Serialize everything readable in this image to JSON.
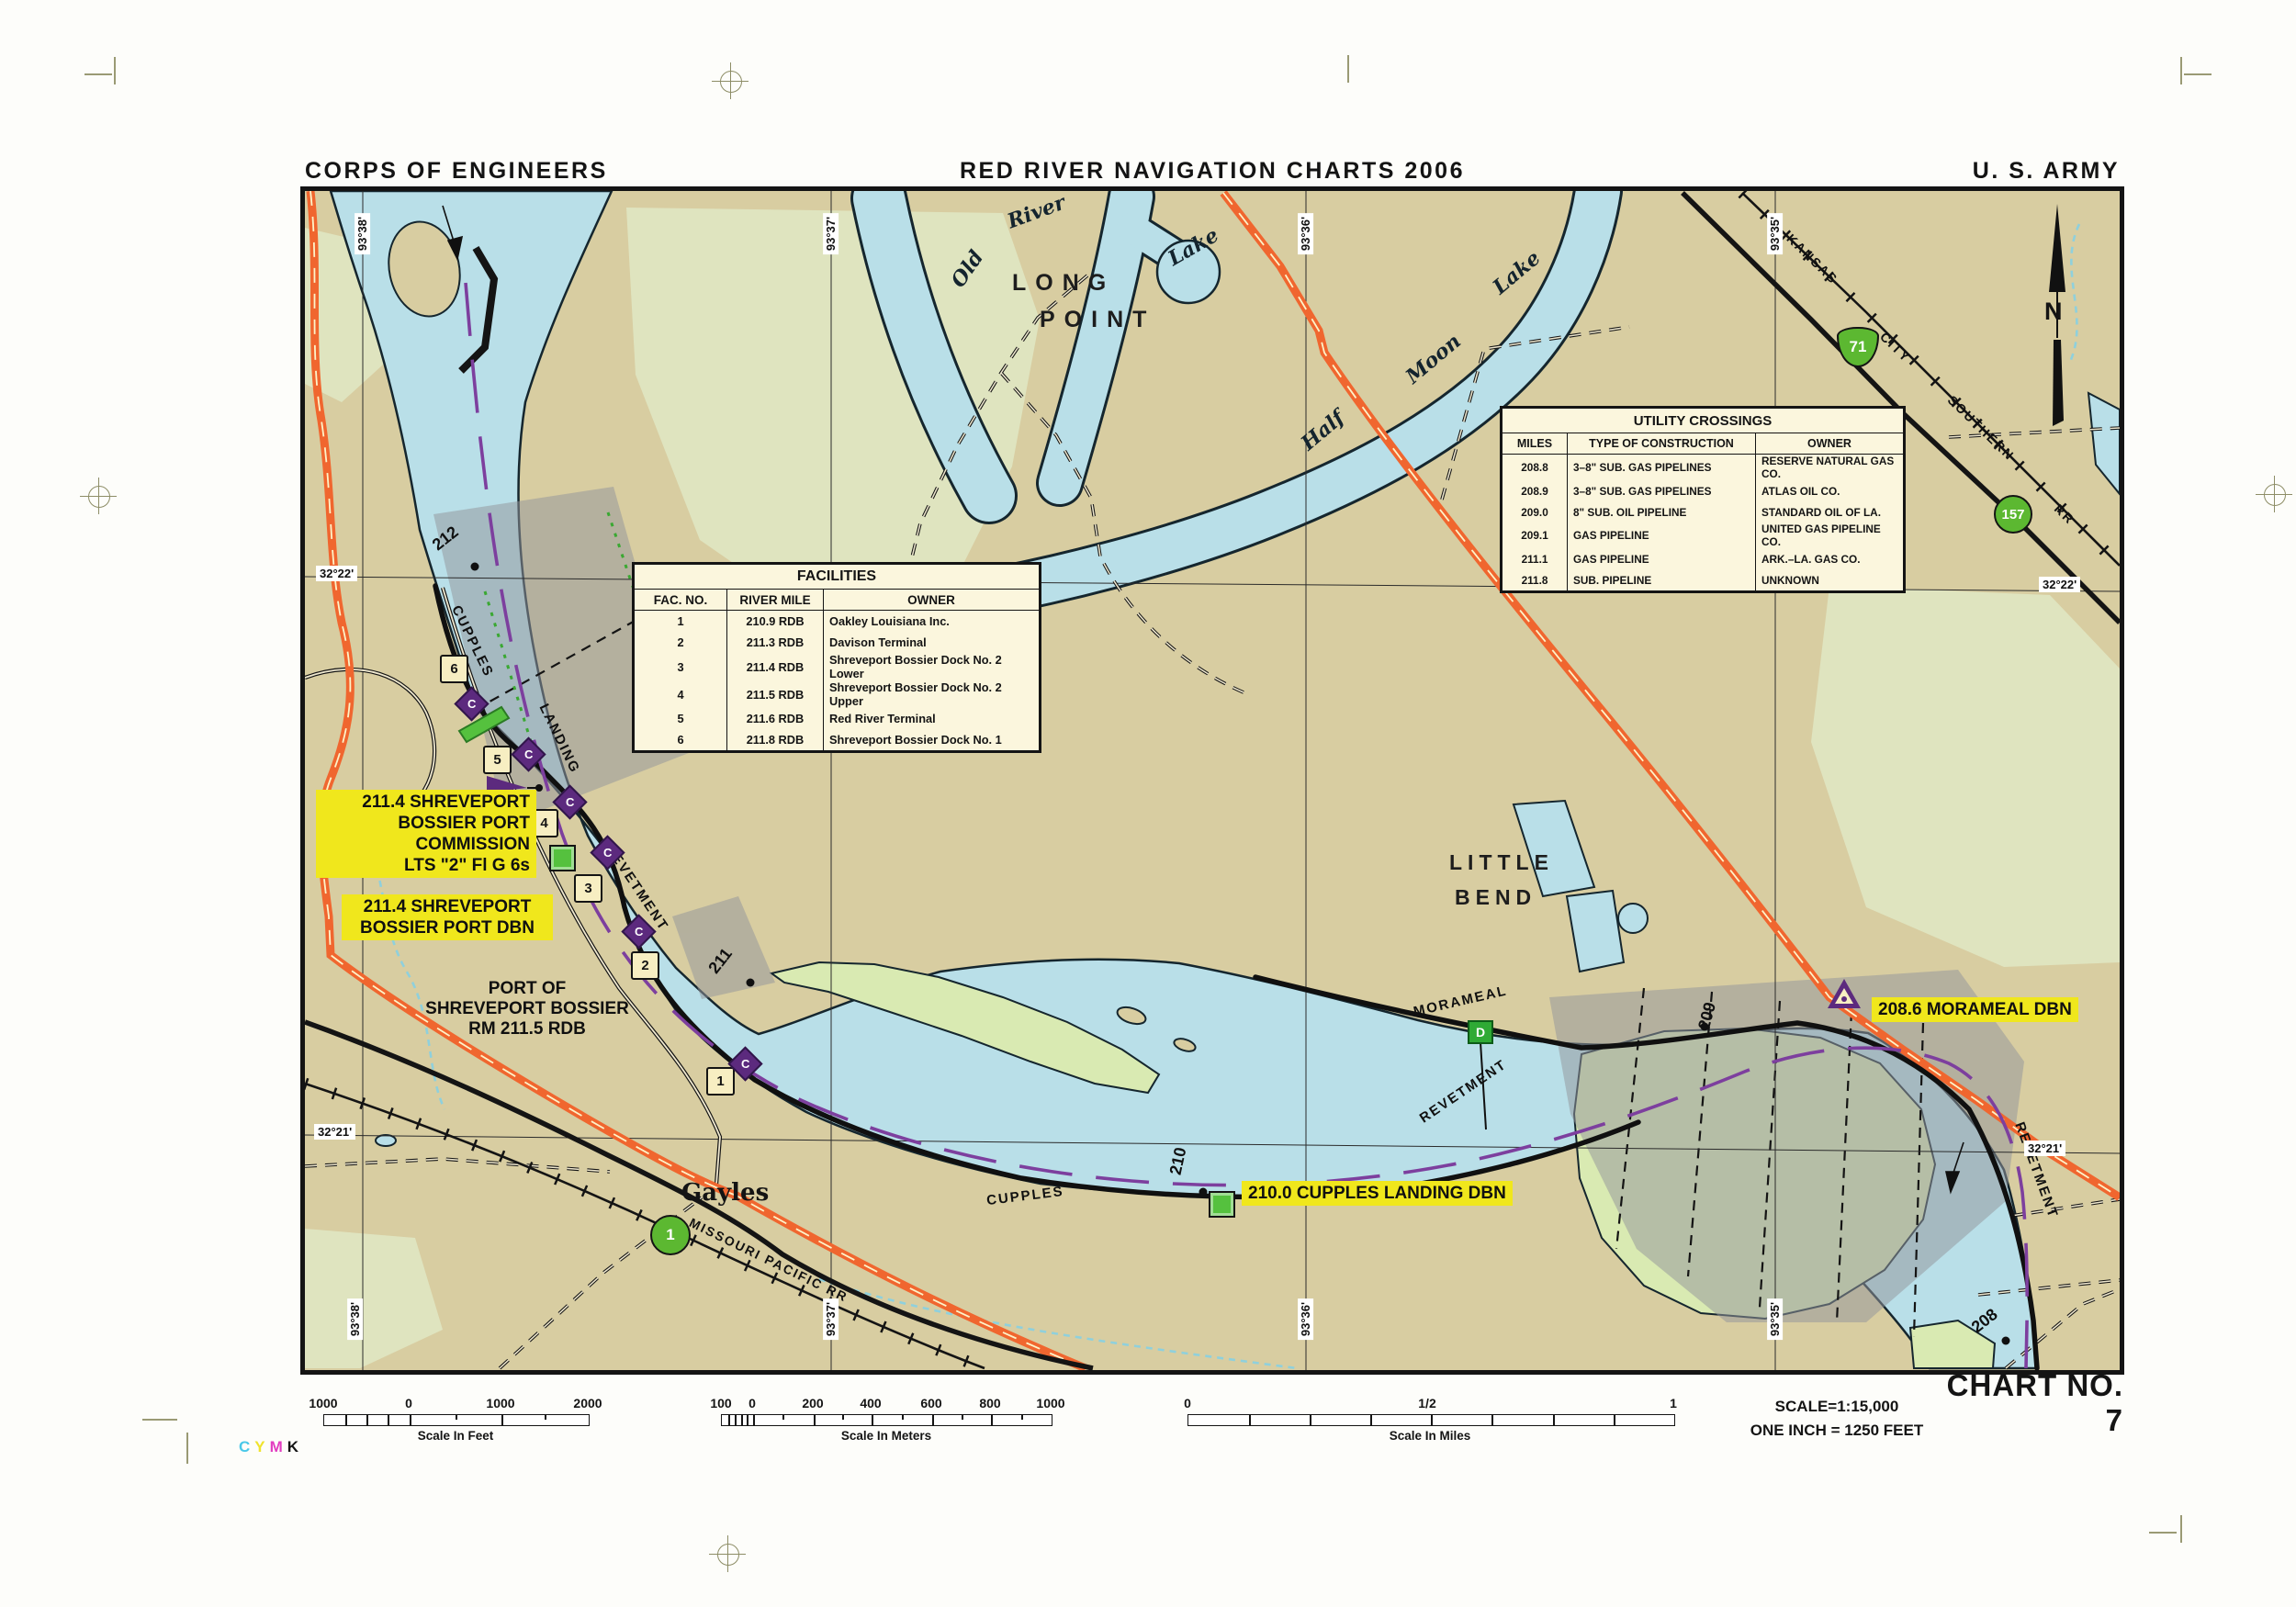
{
  "header": {
    "left": "CORPS OF ENGINEERS",
    "center": "RED RIVER NAVIGATION CHARTS 2006",
    "right": "U. S. ARMY"
  },
  "facilities_table": {
    "title": "FACILITIES",
    "headers": [
      "FAC. NO.",
      "RIVER MILE",
      "OWNER"
    ],
    "rows": [
      [
        "1",
        "210.9  RDB",
        "Oakley Louisiana Inc."
      ],
      [
        "2",
        "211.3  RDB",
        "Davison Terminal"
      ],
      [
        "3",
        "211.4  RDB",
        "Shreveport Bossier Dock No. 2 Lower"
      ],
      [
        "4",
        "211.5  RDB",
        "Shreveport Bossier Dock No. 2 Upper"
      ],
      [
        "5",
        "211.6  RDB",
        "Red River Terminal"
      ],
      [
        "6",
        "211.8  RDB",
        "Shreveport Bossier Dock No. 1"
      ]
    ]
  },
  "utility_table": {
    "title": "UTILITY  CROSSINGS",
    "headers": [
      "MILES",
      "TYPE OF CONSTRUCTION",
      "OWNER"
    ],
    "rows": [
      [
        "208.8",
        "3–8\" SUB. GAS PIPELINES",
        "RESERVE NATURAL GAS CO."
      ],
      [
        "208.9",
        "3–8\" SUB. GAS PIPELINES",
        "ATLAS OIL CO."
      ],
      [
        "209.0",
        "8\" SUB. OIL PIPELINE",
        "STANDARD OIL OF LA."
      ],
      [
        "209.1",
        "GAS PIPELINE",
        "UNITED GAS PIPELINE CO."
      ],
      [
        "211.1",
        "GAS PIPELINE",
        "ARK.–LA. GAS CO."
      ],
      [
        "211.8",
        "SUB. PIPELINE",
        "UNKNOWN"
      ]
    ]
  },
  "annotations": {
    "port_commission": [
      "211.4 SHREVEPORT",
      "BOSSIER PORT",
      "COMMISSION",
      "LTS \"2\" Fl G 6s"
    ],
    "port_dbn": [
      "211.4 SHREVEPORT",
      "BOSSIER PORT DBN"
    ],
    "morameal_dbn": "208.6 MORAMEAL DBN",
    "cupples_dbn": "210.0 CUPPLES LANDING DBN",
    "port_of": [
      "PORT OF",
      "SHREVEPORT BOSSIER",
      "RM 211.5 RDB"
    ]
  },
  "map": {
    "places": {
      "long1": "LONG",
      "long2": "POINT",
      "little1": "LITTLE",
      "little2": "BEND",
      "gayles": "Gayles",
      "old": "Old",
      "river": "River",
      "lake_oxbow": "Lake",
      "half": "Half",
      "moon": "Moon",
      "lake_half": "Lake"
    },
    "reaches": {
      "cupples_upper": "CUPPLES",
      "landing": "LANDING",
      "revetment_upper": "REVETMENT",
      "cupples_lower": "CUPPLES",
      "morameal": "MORAMEAL",
      "revetment_mid": "REVETMENT",
      "revetment_right": "REVETMENT"
    },
    "railroads": {
      "kcs": [
        "KANSAS",
        "CITY",
        "SOUTHERN",
        "RR"
      ],
      "mp": "MISSOURI  PACIFIC  RR"
    },
    "miles": {
      "m212": "212",
      "m211": "211",
      "m210": "210",
      "m209": "209",
      "m208": "208"
    },
    "facility_markers": [
      "1",
      "2",
      "3",
      "4",
      "5",
      "6"
    ],
    "c_mark": "C",
    "d_mark": "D",
    "north": "N",
    "highways": {
      "us71": "71",
      "la157": "157",
      "la1": "1"
    },
    "coords": {
      "lon3838": "93°38'",
      "lon3737": "93°37'",
      "lon3636": "93°36'",
      "lon3535": "93°35'",
      "lat3222": "32°22'",
      "lat3221": "32°21'"
    },
    "colors": {
      "water": "#b9dfe8",
      "land": "#d8cda1",
      "highway_orange": "#f0662f",
      "marker_purple": "#5c2a7e",
      "marker_green": "#55c13e",
      "highlight_yellow": "#f0e71c"
    }
  },
  "scalebars": {
    "feet": {
      "labels": [
        "1000",
        "0",
        "1000",
        "2000"
      ],
      "caption": "Scale In Feet"
    },
    "meters": {
      "labels": [
        "100",
        "0",
        "200",
        "400",
        "600",
        "800",
        "1000"
      ],
      "caption": "Scale In Meters"
    },
    "miles": {
      "labels": [
        "0",
        "1/2",
        "1"
      ],
      "caption": "Scale In Miles"
    }
  },
  "footer": {
    "scale": "SCALE=1:15,000",
    "inch": "ONE INCH = 1250 FEET",
    "chart_no": "CHART NO. 7"
  },
  "print": {
    "c": "C",
    "y": "Y",
    "m": "M",
    "k": "K"
  }
}
